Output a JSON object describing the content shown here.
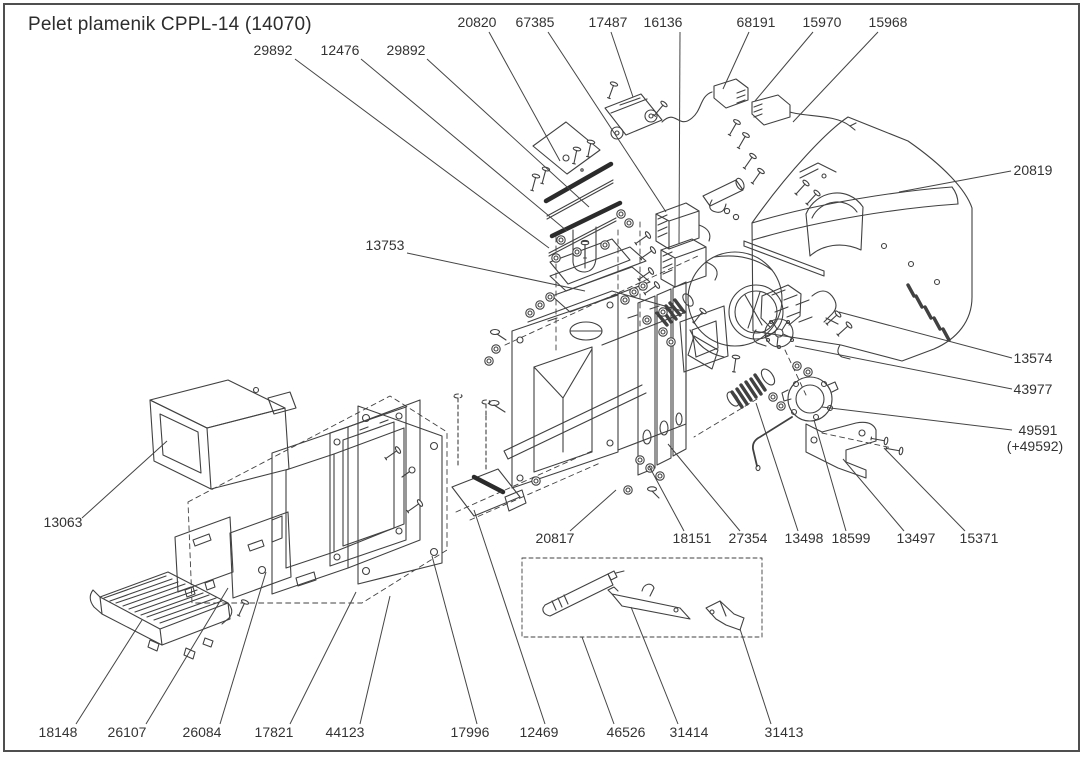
{
  "title": "Pelet plamenik CPPL-14 (14070)",
  "colors": {
    "line": "#414141",
    "dark_fill": "#2b2b2b",
    "text": "#333333",
    "background": "#ffffff",
    "border": "#4f4f4f"
  },
  "diagram": {
    "description": "Exploded parts view of pellet burner CPPL-14 (14070)",
    "part_labels": [
      {
        "part": "20820",
        "x": 477,
        "y": 27,
        "leader": [
          [
            489,
            32
          ],
          [
            560,
            161
          ]
        ]
      },
      {
        "part": "67385",
        "x": 535,
        "y": 27,
        "leader": [
          [
            548,
            32
          ],
          [
            666,
            212
          ]
        ]
      },
      {
        "part": "17487",
        "x": 608,
        "y": 27,
        "leader": [
          [
            611,
            32
          ],
          [
            633,
            97
          ]
        ]
      },
      {
        "part": "16136",
        "x": 663,
        "y": 27,
        "leader": [
          [
            680,
            32
          ],
          [
            679,
            244
          ]
        ]
      },
      {
        "part": "68191",
        "x": 756,
        "y": 27,
        "leader": [
          [
            749,
            32
          ],
          [
            723,
            89
          ]
        ]
      },
      {
        "part": "15970",
        "x": 822,
        "y": 27,
        "leader": [
          [
            813,
            32
          ],
          [
            755,
            101
          ]
        ]
      },
      {
        "part": "15968",
        "x": 888,
        "y": 27,
        "leader": [
          [
            878,
            32
          ],
          [
            793,
            122
          ]
        ]
      },
      {
        "part": "29892",
        "x": 273,
        "y": 55,
        "leader": [
          [
            295,
            59
          ],
          [
            549,
            248
          ]
        ]
      },
      {
        "part": "12476",
        "x": 340,
        "y": 55,
        "leader": [
          [
            361,
            59
          ],
          [
            567,
            231
          ]
        ]
      },
      {
        "part": "29892",
        "x": 406,
        "y": 55,
        "leader": [
          [
            427,
            59
          ],
          [
            589,
            207
          ]
        ]
      },
      {
        "part": "13753",
        "x": 385,
        "y": 250,
        "leader": [
          [
            407,
            253
          ],
          [
            585,
            291
          ]
        ]
      },
      {
        "part": "20819",
        "x": 1033,
        "y": 175,
        "leader": [
          [
            1011,
            171
          ],
          [
            899,
            192
          ]
        ]
      },
      {
        "part": "13574",
        "x": 1033,
        "y": 363,
        "leader": [
          [
            1012,
            358
          ],
          [
            839,
            312
          ]
        ]
      },
      {
        "part": "43977",
        "x": 1033,
        "y": 394,
        "leader": [
          [
            1012,
            389
          ],
          [
            795,
            346
          ]
        ]
      },
      {
        "part": "49591",
        "x": 1038,
        "y": 435,
        "note": "(+49592)",
        "note_x": 1035,
        "note_y": 451,
        "leader": [
          [
            1012,
            430
          ],
          [
            822,
            407
          ]
        ]
      },
      {
        "part": "13063",
        "x": 63,
        "y": 527,
        "leader": [
          [
            82,
            518
          ],
          [
            167,
            441
          ]
        ]
      },
      {
        "part": "20817",
        "x": 555,
        "y": 543,
        "leader": [
          [
            570,
            531
          ],
          [
            616,
            490
          ]
        ]
      },
      {
        "part": "18151",
        "x": 692,
        "y": 543,
        "leader": [
          [
            684,
            531
          ],
          [
            649,
            466
          ]
        ]
      },
      {
        "part": "27354",
        "x": 748,
        "y": 543,
        "leader": [
          [
            740,
            531
          ],
          [
            668,
            444
          ]
        ]
      },
      {
        "part": "13498",
        "x": 804,
        "y": 543,
        "leader": [
          [
            798,
            531
          ],
          [
            756,
            403
          ]
        ]
      },
      {
        "part": "18599",
        "x": 851,
        "y": 543,
        "leader": [
          [
            846,
            531
          ],
          [
            814,
            420
          ]
        ]
      },
      {
        "part": "13497",
        "x": 916,
        "y": 543,
        "leader": [
          [
            904,
            531
          ],
          [
            843,
            459
          ]
        ]
      },
      {
        "part": "15371",
        "x": 979,
        "y": 543,
        "leader": [
          [
            965,
            531
          ],
          [
            884,
            448
          ]
        ]
      },
      {
        "part": "18148",
        "x": 58,
        "y": 737,
        "leader": [
          [
            76,
            724
          ],
          [
            142,
            620
          ]
        ]
      },
      {
        "part": "26107",
        "x": 127,
        "y": 737,
        "leader": [
          [
            146,
            724
          ],
          [
            228,
            588
          ]
        ]
      },
      {
        "part": "26084",
        "x": 202,
        "y": 737,
        "leader": [
          [
            220,
            724
          ],
          [
            266,
            572
          ]
        ]
      },
      {
        "part": "17821",
        "x": 274,
        "y": 737,
        "leader": [
          [
            290,
            724
          ],
          [
            356,
            592
          ]
        ]
      },
      {
        "part": "44123",
        "x": 345,
        "y": 737,
        "leader": [
          [
            360,
            724
          ],
          [
            390,
            596
          ]
        ]
      },
      {
        "part": "17996",
        "x": 470,
        "y": 737,
        "leader": [
          [
            477,
            724
          ],
          [
            432,
            556
          ]
        ]
      },
      {
        "part": "12469",
        "x": 539,
        "y": 737,
        "leader": [
          [
            545,
            724
          ],
          [
            474,
            510
          ]
        ]
      },
      {
        "part": "46526",
        "x": 626,
        "y": 737,
        "leader": [
          [
            614,
            724
          ],
          [
            582,
            637
          ]
        ]
      },
      {
        "part": "31414",
        "x": 689,
        "y": 737,
        "leader": [
          [
            678,
            724
          ],
          [
            631,
            607
          ]
        ]
      },
      {
        "part": "31413",
        "x": 784,
        "y": 737,
        "leader": [
          [
            771,
            724
          ],
          [
            740,
            629
          ]
        ]
      }
    ]
  }
}
